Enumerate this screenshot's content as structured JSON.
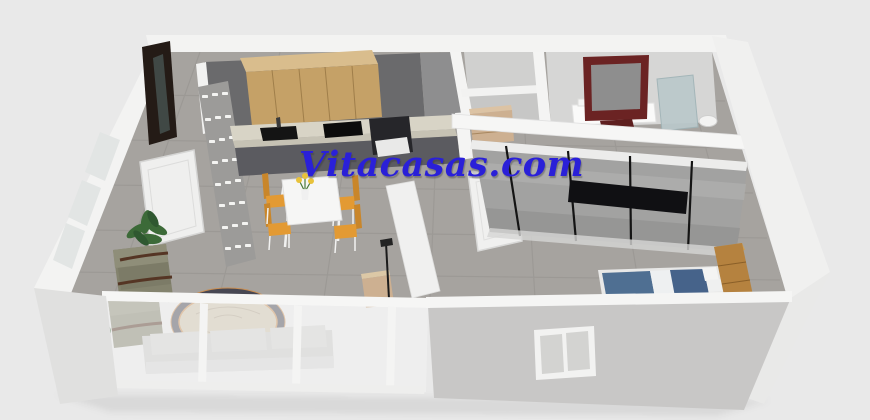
{
  "watermark": {
    "text": "Vitacasas.com"
  },
  "scene": {
    "description": "3D isometric floor-plan render of an apartment (real-estate listing image)",
    "elements": [
      "entry-wardrobe",
      "entry-door",
      "accent-wall",
      "kitchen-upper-cabinets",
      "kitchen-counter",
      "kitchen-sink",
      "cooktop",
      "oven",
      "dining-table",
      "dining-chairs",
      "flower-vase",
      "hallway-partition",
      "floor-lamp",
      "side-cabinet",
      "armchairs",
      "potted-plant",
      "side-table",
      "oval-rug",
      "sofa",
      "balcony-glass-wall",
      "left-windows",
      "closet-chest",
      "hallway-door",
      "master-dresser",
      "maroon-mirror",
      "glass-shower-panel",
      "sliding-wardrobe",
      "double-bed",
      "wooden-wardrobe",
      "bedroom-window"
    ],
    "palette": {
      "bg": "#e9e9e9",
      "watermark_blue": "#2a20d8",
      "wall_white": "#f3f3f2",
      "wall_shade": "#d6d6d5",
      "front_wall": "#c8c7c6",
      "floor_gray": "#a6a39f",
      "kitchen_wall": "#6a6a6c",
      "wood_cabinet": "#c5a167",
      "wood_cabinet_top": "#d9bd8d",
      "counter": "#d8d4c6",
      "appliance_black": "#141414",
      "base_cabinet": "#5b5b60",
      "entry_unit": "#241b16",
      "chair_orange": "#e39a33",
      "armchair_olive": "#84836e",
      "rug_border": "#474752",
      "rug_field": "#cfc3ac",
      "rug_trim": "#c98e52",
      "mirror_maroon": "#6b2323",
      "bed_blue": "#4f6f92",
      "wardrobe_gray": "#a2a2a1",
      "closet_wood": "#cdb091",
      "window_glass": "#e2e5e4",
      "glass_tint": "rgba(242,243,243,0.55)",
      "plant_green": "#3c6a38",
      "sofa_gray": "#c9c9c7"
    }
  }
}
